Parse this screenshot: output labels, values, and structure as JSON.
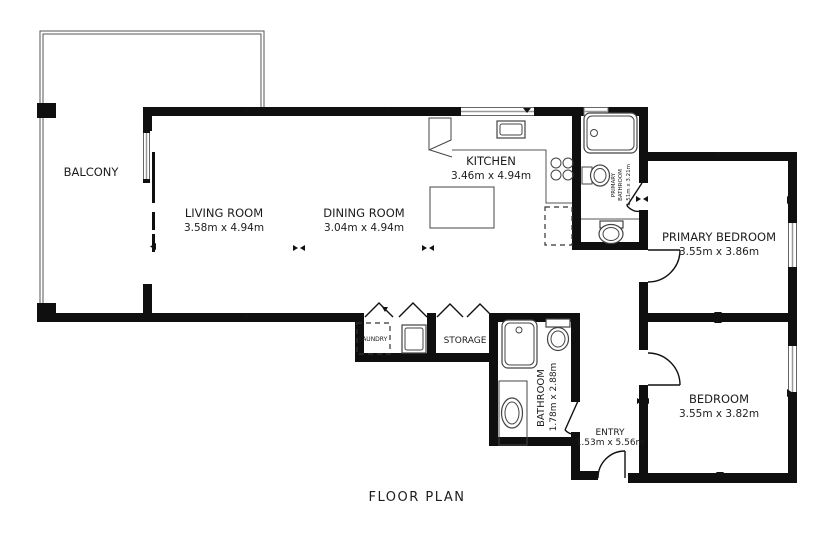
{
  "title": "FLOOR PLAN",
  "rooms": {
    "balcony": {
      "name": "BALCONY"
    },
    "living": {
      "name": "LIVING ROOM",
      "dims": "3.58m x 4.94m"
    },
    "dining": {
      "name": "DINING ROOM",
      "dims": "3.04m x 4.94m"
    },
    "kitchen": {
      "name": "KITCHEN",
      "dims": "3.46m x 4.94m"
    },
    "primary_bathroom": {
      "name_top": "PRIMARY",
      "name_bottom": "BATHROOM",
      "dims": "1.51m x 3.21m"
    },
    "primary_bedroom": {
      "name": "PRIMARY BEDROOM",
      "dims": "3.55m x 3.86m"
    },
    "bedroom": {
      "name": "BEDROOM",
      "dims": "3.55m x 3.82m"
    },
    "bathroom": {
      "name": "BATHROOM",
      "dims": "1.78m x 2.88m"
    },
    "laundry": {
      "name": "LAUNDRY"
    },
    "storage": {
      "name": "STORAGE"
    },
    "entry": {
      "name": "ENTRY",
      "dims": "1.53m x 5.56m"
    }
  },
  "colors": {
    "wall": "#0f0f0f",
    "line": "#555555",
    "text": "#1c1c1c",
    "background": "#ffffff"
  }
}
